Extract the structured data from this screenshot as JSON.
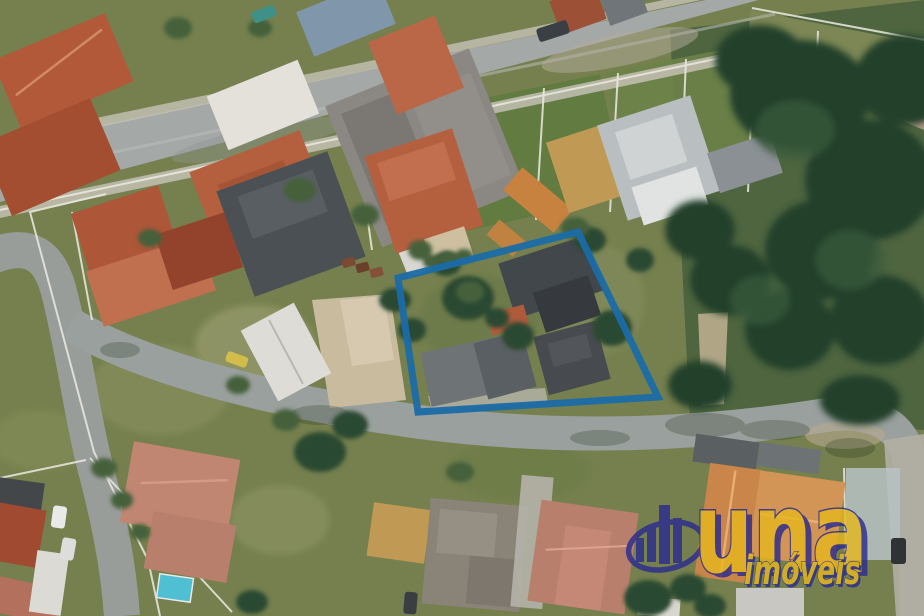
{
  "overlay": {
    "polygon": {
      "points": "398,278 578,232 658,397 418,412",
      "stroke": "#1a6ca8",
      "stroke_width": 7,
      "opacity": 0.95
    }
  },
  "watermark": {
    "brand": "una",
    "tagline": "imóveis",
    "opacity": 0.82,
    "colors": {
      "navy": "#2b2b8f",
      "yellow": "#e6b71f"
    }
  },
  "palette": {
    "grass": "#75804e",
    "lawn_green": "#5e7a3e",
    "tree_dark": "#24402b",
    "road_gray": "#a2a7a6",
    "sand": "#c9bb9e",
    "terracotta": "#b2593a",
    "charcoal_roof": "#42474b",
    "highlight_blue": "#1a6ca8"
  }
}
